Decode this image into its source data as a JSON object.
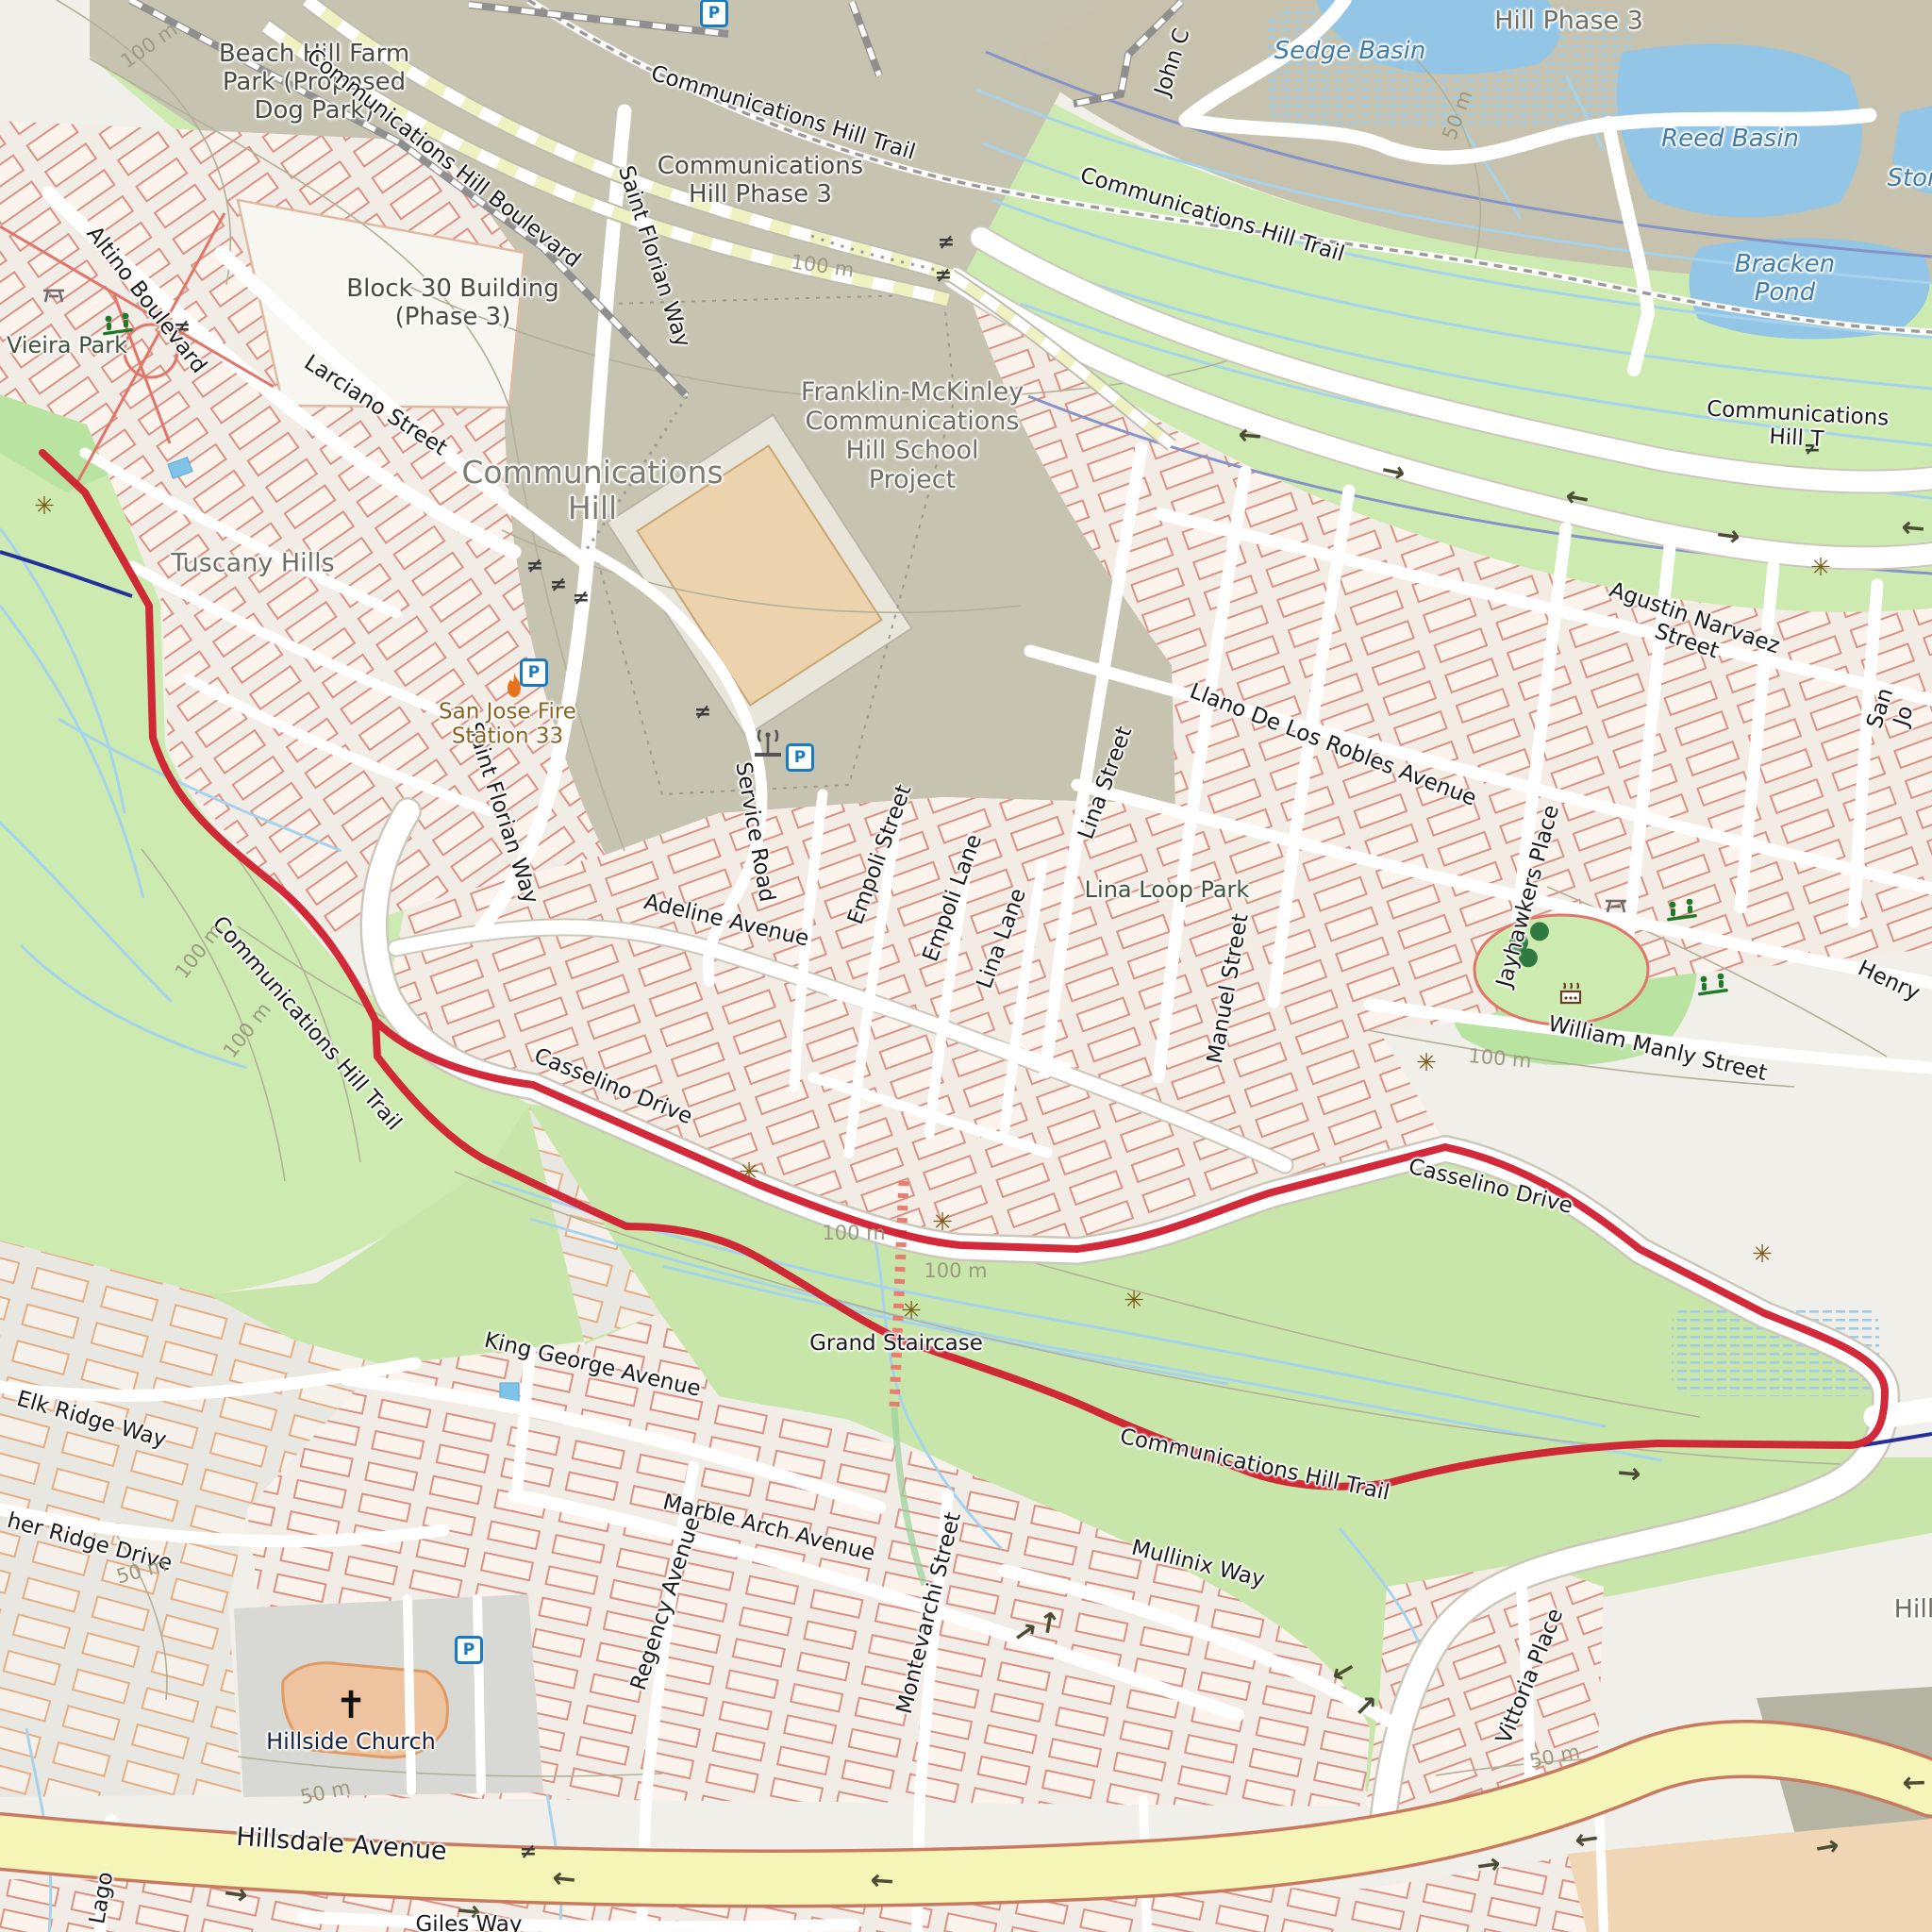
{
  "app": {
    "type": "map-view",
    "style": "openstreetmap-carto",
    "route_color": "#d01f2f"
  },
  "labels": {
    "beach_hill_park": "Beach Hill Farm\nPark (Proposed\nDog Park)",
    "comm_hill_blvd": "Communications Hill Boulevard",
    "trail": "Communications Hill Trail",
    "trail_cut": "Communications Hill T",
    "comm_hill_phase3": "Communications\nHill Phase 3",
    "hill_phase3": "Hill Phase 3",
    "sedge_basin": "Sedge Basin",
    "reed_basin": "Reed Basin",
    "bracken_pond": "Bracken Pond",
    "ston_cut": "Ston",
    "john_c_cut": "John C",
    "vieira_park": "Vieira Park",
    "altino_blvd": "Altino Boulevard",
    "block30": "Block 30 Building\n(Phase 3)",
    "larciano": "Larciano Street",
    "saint_florian": "Saint Florian Way",
    "comm_hill_place": "Communications\nHill",
    "school_project": "Franklin-McKinley\nCommunications\nHill School\nProject",
    "tuscany_hills": "Tuscany Hills",
    "fire_station": "San Jose Fire\nStation 33",
    "service_road": "Service Road",
    "agustin_narvaez": "Agustin Narvaez Street",
    "llano_robles": "Llano De Los Robles Avenue",
    "lina_street": "Lina Street",
    "empoli_street": "Empoli Street",
    "empoli_lane": "Empoli Lane",
    "lina_lane": "Lina Lane",
    "lina_loop_park": "Lina Loop Park",
    "manuel_street": "Manuel Street",
    "jayhawkers_place": "Jayhawkers Place",
    "adeline_ave": "Adeline Avenue",
    "casselino_drive": "Casselino Drive",
    "william_manly": "William Manly Street",
    "henry_cut": "Henry",
    "san_jo_cut": "San Jo",
    "grand_staircase": "Grand Staircase",
    "king_george": "King George Avenue",
    "elk_ridge": "Elk Ridge Way",
    "her_ridge_cut": "her Ridge Drive",
    "marble_arch": "Marble Arch Avenue",
    "regency_ave": "Regency Avenue",
    "montevarchi": "Montevarchi Street",
    "mullinix_way": "Mullinix Way",
    "vittoria_place": "Vittoria Place",
    "hillside_church": "Hillside Church",
    "hillsdale_ave": "Hillsdale Avenue",
    "giles_way": "Giles Way",
    "lago_cut": "Lago",
    "hills_cut": "Hills",
    "contour_100": "100 m",
    "contour_50": "50 m"
  },
  "icons": {
    "parking": "P",
    "level_crossing": "≠",
    "oneway_arrow": "→",
    "viewpoint": "✳",
    "church_cross": "✝",
    "tree": "●"
  },
  "colors": {
    "route": "#d01f2f",
    "secondary_route": "#23309b",
    "grass": "#cdebb0",
    "scrub_brown": "#c6c4b1",
    "water": "#92c5e6",
    "road_yellow": "#f5f5b8",
    "building_outline": "#da9183",
    "telecom_site": "#edd2ae"
  }
}
